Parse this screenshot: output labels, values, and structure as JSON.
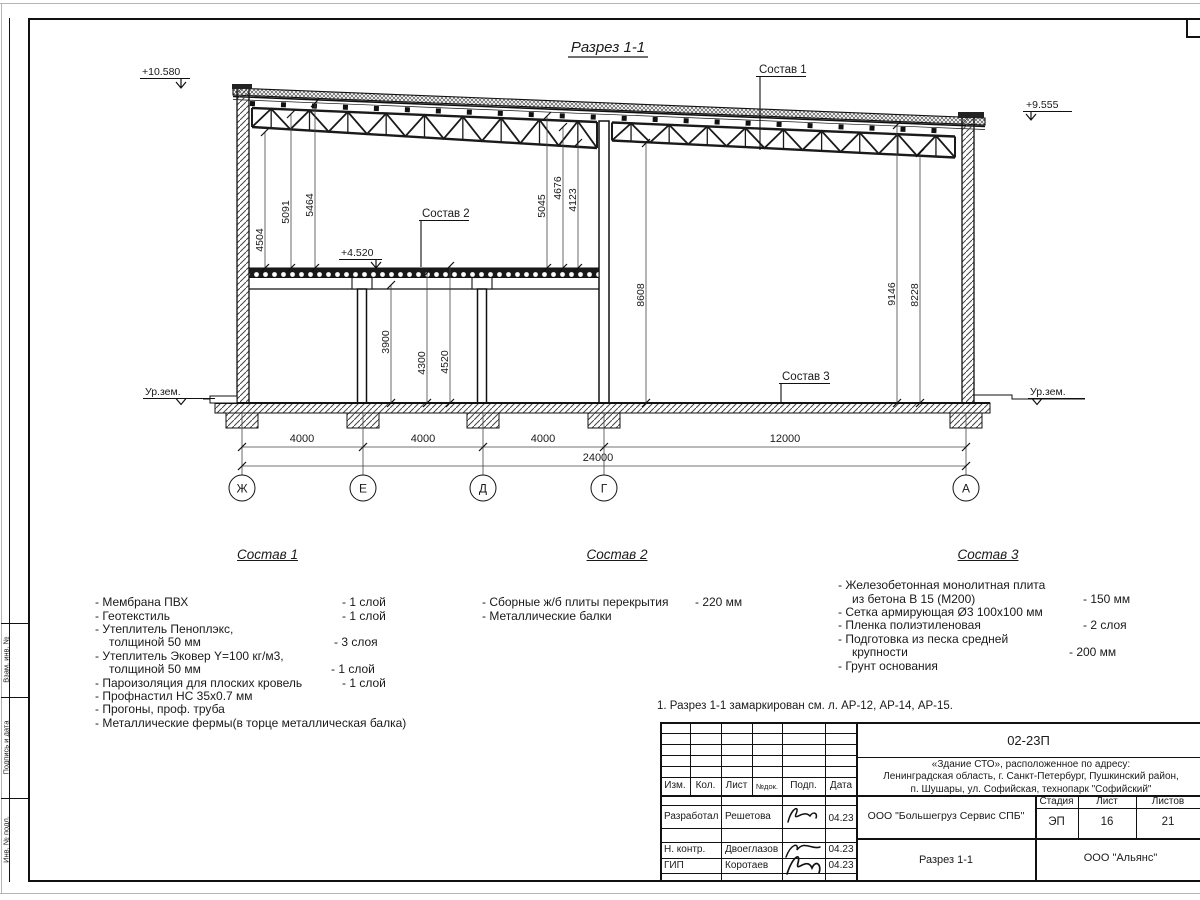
{
  "sheet": {
    "note": "1. Разрез 1-1 замаркирован см. л. АР-12, АР-14, АР-15.",
    "margin_labels": [
      "Взам. инв. №",
      "Подпись и дата",
      "Инв. № подл."
    ]
  },
  "section": {
    "title": "Разрез 1-1",
    "elevations": {
      "roof_left": "+10.580",
      "roof_right": "+9.555",
      "mezz": "+4.520",
      "ground_left": "Ур.зем.",
      "ground_right": "Ур.зем."
    },
    "callouts": {
      "c1": "Состав 1",
      "c2": "Состав 2",
      "c3": "Состав 3"
    },
    "dims_vertical": {
      "v4504": "4504",
      "v5091": "5091",
      "v5464": "5464",
      "v5045": "5045",
      "v4676": "4676",
      "v4123": "4123",
      "v3900": "3900",
      "v4300": "4300",
      "v4520": "4520",
      "v8608": "8608",
      "v9146": "9146",
      "v8228": "8228"
    },
    "dims_horizontal": {
      "b1": "4000",
      "b2": "4000",
      "b3": "4000",
      "b4": "12000",
      "total": "24000"
    },
    "axes": [
      "Ж",
      "Е",
      "Д",
      "Г",
      "А"
    ]
  },
  "compositions": [
    {
      "title": "Состав 1",
      "items": [
        {
          "name": "- Мембрана ПВХ",
          "value": "- 1 слой"
        },
        {
          "name": "- Геотекстиль",
          "value": "- 1 слой"
        },
        {
          "name": "- Утеплитель Пеноплэкс,",
          "value": ""
        },
        {
          "name": "толщиной 50 мм",
          "value": "- 3 слоя"
        },
        {
          "name": "- Утеплитель Эковер Y=100 кг/м3,",
          "value": ""
        },
        {
          "name": "толщиной 50 мм",
          "value": "- 1 слой"
        },
        {
          "name": "- Пароизоляция для плоских кровель",
          "value": "- 1 слой"
        },
        {
          "name": "- Профнастил НС 35х0.7 мм",
          "value": ""
        },
        {
          "name": "- Прогоны, проф. труба",
          "value": ""
        },
        {
          "name": "- Металлические фермы(в торце металлическая балка)",
          "value": ""
        }
      ]
    },
    {
      "title": "Состав 2",
      "items": [
        {
          "name": "- Сборные ж/б плиты перекрытия",
          "value": "- 220 мм"
        },
        {
          "name": "- Металлические балки",
          "value": ""
        }
      ]
    },
    {
      "title": "Состав 3",
      "items": [
        {
          "name": "- Железобетонная  монолитная плита",
          "value": ""
        },
        {
          "name": "из бетона В 15 (М200)",
          "value": "- 150 мм"
        },
        {
          "name": "- Сетка армирующая Ø3 100х100 мм",
          "value": ""
        },
        {
          "name": "- Пленка полиэтиленовая",
          "value": "-  2 слоя"
        },
        {
          "name": "- Подготовка из песка средней",
          "value": ""
        },
        {
          "name": "крупности",
          "value": "- 200 мм"
        },
        {
          "name": "- Грунт основания",
          "value": ""
        }
      ]
    }
  ],
  "title_block": {
    "code": "02-23П",
    "project_line1": "«Здание СТО», расположенное по адресу:",
    "project_line2": "Ленинградская область, г. Санкт-Петербург, Пушкинский район,",
    "project_line3": "п. Шушары, ул. Софийская, технопарк \"Софийский\"",
    "columns": [
      "Изм.",
      "Кол.",
      "Лист",
      "№док.",
      "Подп.",
      "Дата"
    ],
    "rows": [
      {
        "role": "Разработал",
        "name": "Решетова",
        "date": "04.23"
      },
      {
        "role": "Н. контр.",
        "name": "Двоеглазов",
        "date": "04.23"
      },
      {
        "role": "ГИП",
        "name": "Коротаев",
        "date": "04.23"
      }
    ],
    "org": "ООО \"Большегруз Сервис СПБ\"",
    "doc_name": "Разрез 1-1",
    "contractor": "ООО \"Альянс\"",
    "stage_label": "Стадия",
    "sheet_label": "Лист",
    "sheets_label": "Листов",
    "stage": "ЭП",
    "sheet": "16",
    "sheets": "21"
  }
}
